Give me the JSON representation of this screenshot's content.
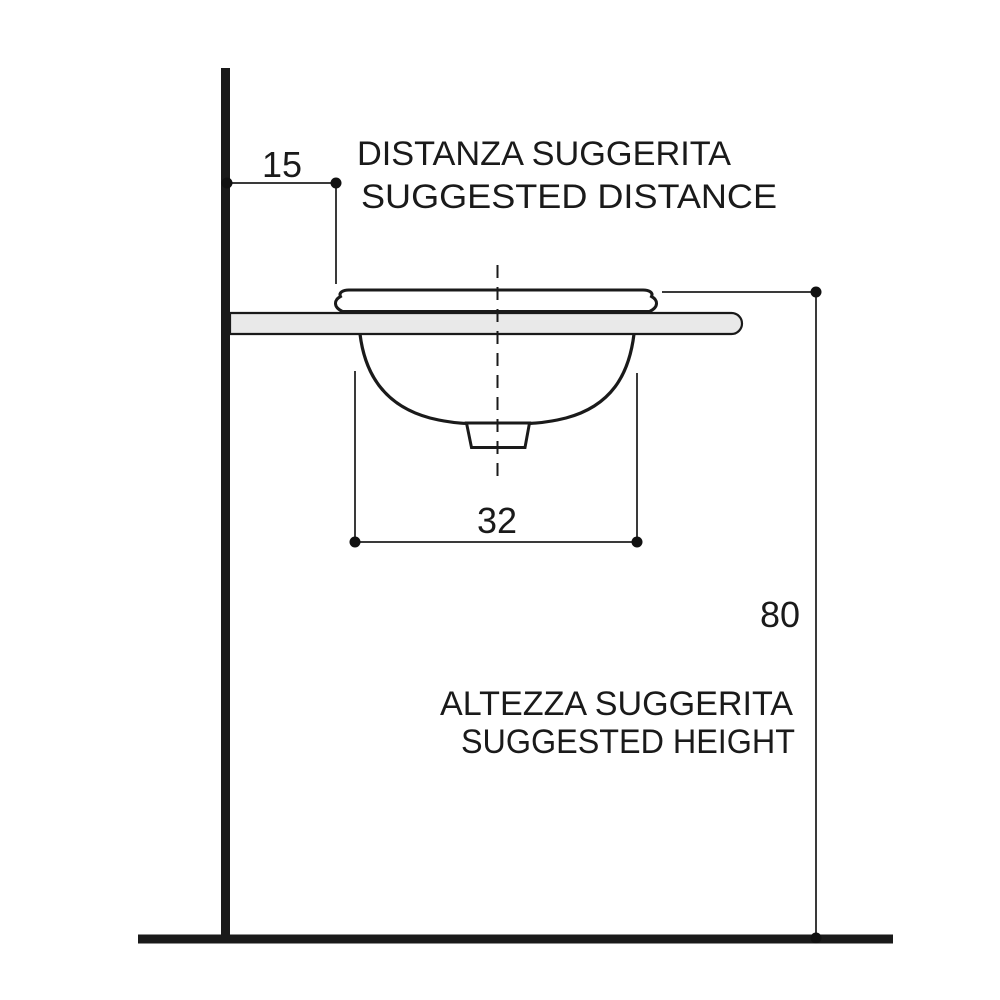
{
  "diagram": {
    "distance": {
      "value": "15",
      "label_it": "DISTANZA SUGGERITA",
      "label_en": "SUGGESTED DISTANCE"
    },
    "basin_width": {
      "value": "32"
    },
    "height": {
      "value": "80",
      "label_it": "ALTEZZA SUGGERITA",
      "label_en": "SUGGESTED HEIGHT"
    },
    "colors": {
      "outline": "#1a1a1a",
      "dimension_line": "#3a3a3a",
      "countertop_fill": "#e9e9e9",
      "background": "#ffffff"
    }
  }
}
